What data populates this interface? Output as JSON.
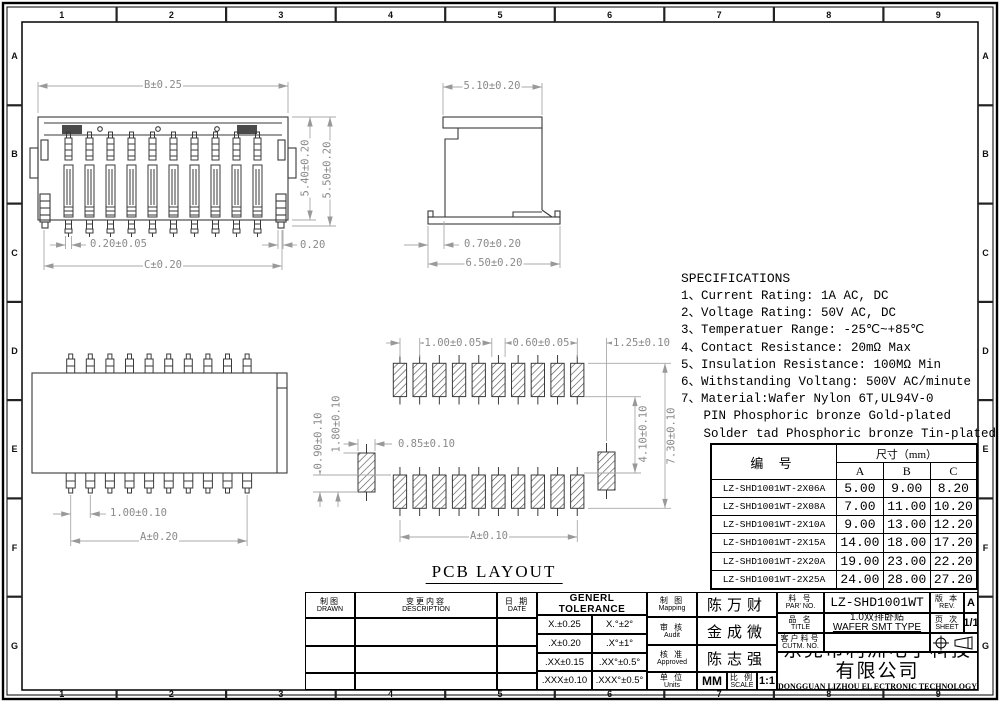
{
  "frame": {
    "cols": [
      "1",
      "2",
      "3",
      "4",
      "5",
      "6",
      "7",
      "8",
      "9"
    ],
    "rows": [
      "A",
      "B",
      "C",
      "D",
      "E",
      "F",
      "G"
    ]
  },
  "dims": {
    "front": {
      "b": "B±0.25",
      "h54": "5.40±0.20",
      "h55": "5.50±0.20",
      "pin": "0.20±0.05",
      "edge": "0.20",
      "c": "C±0.20"
    },
    "side": {
      "w": "5.10±0.20",
      "foot": "0.70±0.20",
      "base": "6.50±0.20"
    },
    "top": {
      "pitch": "1.00±0.10",
      "a": "A±0.20"
    },
    "pcb": {
      "pitch": "1.00±0.05",
      "pad": "0.60±0.05",
      "corner": "1.25±0.10",
      "side_pad": "0.85±0.10",
      "p090": "0.90±0.10",
      "p180": "1.80±0.10",
      "p410": "4.10±0.10",
      "p730": "7.30±0.10",
      "a": "A±0.10",
      "title": "PCB LAYOUT"
    }
  },
  "specs": {
    "title": "SPECIFICATIONS",
    "lines": [
      "1、Current Rating: 1A AC, DC",
      "2、Voltage Rating: 50V AC, DC",
      "3、Temperatuer Range: -25℃~+85℃",
      "4、Contact Resistance: 20mΩ Max",
      "5、Insulation Resistance: 100MΩ Min",
      "6、Withstanding Voltang: 500V AC/minute",
      "7、Material:Wafer Nylon 6T,UL94V-0",
      "   PIN Phosphoric bronze Gold-plated",
      "   Solder tad Phosphoric bronze Tin-plated"
    ]
  },
  "table": {
    "col_pn": "编  号",
    "col_size": "尺寸（mm）",
    "cols": [
      "A",
      "B",
      "C"
    ],
    "rows": [
      {
        "pn": "LZ-SHD1001WT-2X06A",
        "a": "5.00",
        "b": "9.00",
        "c": "8.20"
      },
      {
        "pn": "LZ-SHD1001WT-2X08A",
        "a": "7.00",
        "b": "11.00",
        "c": "10.20"
      },
      {
        "pn": "LZ-SHD1001WT-2X10A",
        "a": "9.00",
        "b": "13.00",
        "c": "12.20"
      },
      {
        "pn": "LZ-SHD1001WT-2X15A",
        "a": "14.00",
        "b": "18.00",
        "c": "17.20"
      },
      {
        "pn": "LZ-SHD1001WT-2X20A",
        "a": "19.00",
        "b": "23.00",
        "c": "22.20"
      },
      {
        "pn": "LZ-SHD1001WT-2X25A",
        "a": "24.00",
        "b": "28.00",
        "c": "27.20"
      }
    ]
  },
  "titleblock": {
    "drawn_cn": "制图",
    "drawn_en": "DRAWN",
    "description_cn": "变更内容",
    "description_en": "DESCRIPTION",
    "date_cn": "日 期",
    "date_en": "DATE",
    "tolerance_title": "GENERL TOLERANCE",
    "tolerance": [
      {
        "lin": "X.±0.25",
        "ang": "X.°±2°"
      },
      {
        "lin": ".X±0.20",
        "ang": ".X°±1°"
      },
      {
        "lin": ".XX±0.15",
        "ang": ".XX°±0.5°"
      },
      {
        "lin": ".XXX±0.10",
        "ang": ".XXX°±0.5°"
      }
    ],
    "mapping_cn": "制 图",
    "mapping_en": "Mapping",
    "mapping_name": "陈万财",
    "audit_cn": "审 核",
    "audit_en": "Audit",
    "audit_name": "金成微",
    "approved_cn": "核 准",
    "approved_en": "Approved",
    "approved_name": "陈志强",
    "units_cn": "单 位",
    "units_en": "Units",
    "units_value": "MM",
    "scale_cn": "比 例",
    "scale_en": "SCALE",
    "scale_value": "1:1",
    "part_no_cn": "料 号",
    "part_no_en": "PAR' NO.",
    "part_no_value": "LZ-SHD1001WT",
    "name_cn": "品 名",
    "name_en": "TITLE",
    "name_value_cn": "1.0双排卧贴",
    "name_value_en": "WAFER SMT TYPE",
    "customer_cn": "客户料号",
    "customer_en": "CUTM. NO.",
    "customer_value": "",
    "rev_cn": "版 本",
    "rev_en": "REV.",
    "rev_value": "A",
    "sheet_cn": "页 次",
    "sheet_en": "SHEET",
    "sheet_value": "1/1",
    "company_cn": "东莞市利洲电子科技有限公司",
    "company_en": "DONGGUAN LIZHOU EL ECTRONIC TECHNOLOGY CO.,LTD"
  }
}
